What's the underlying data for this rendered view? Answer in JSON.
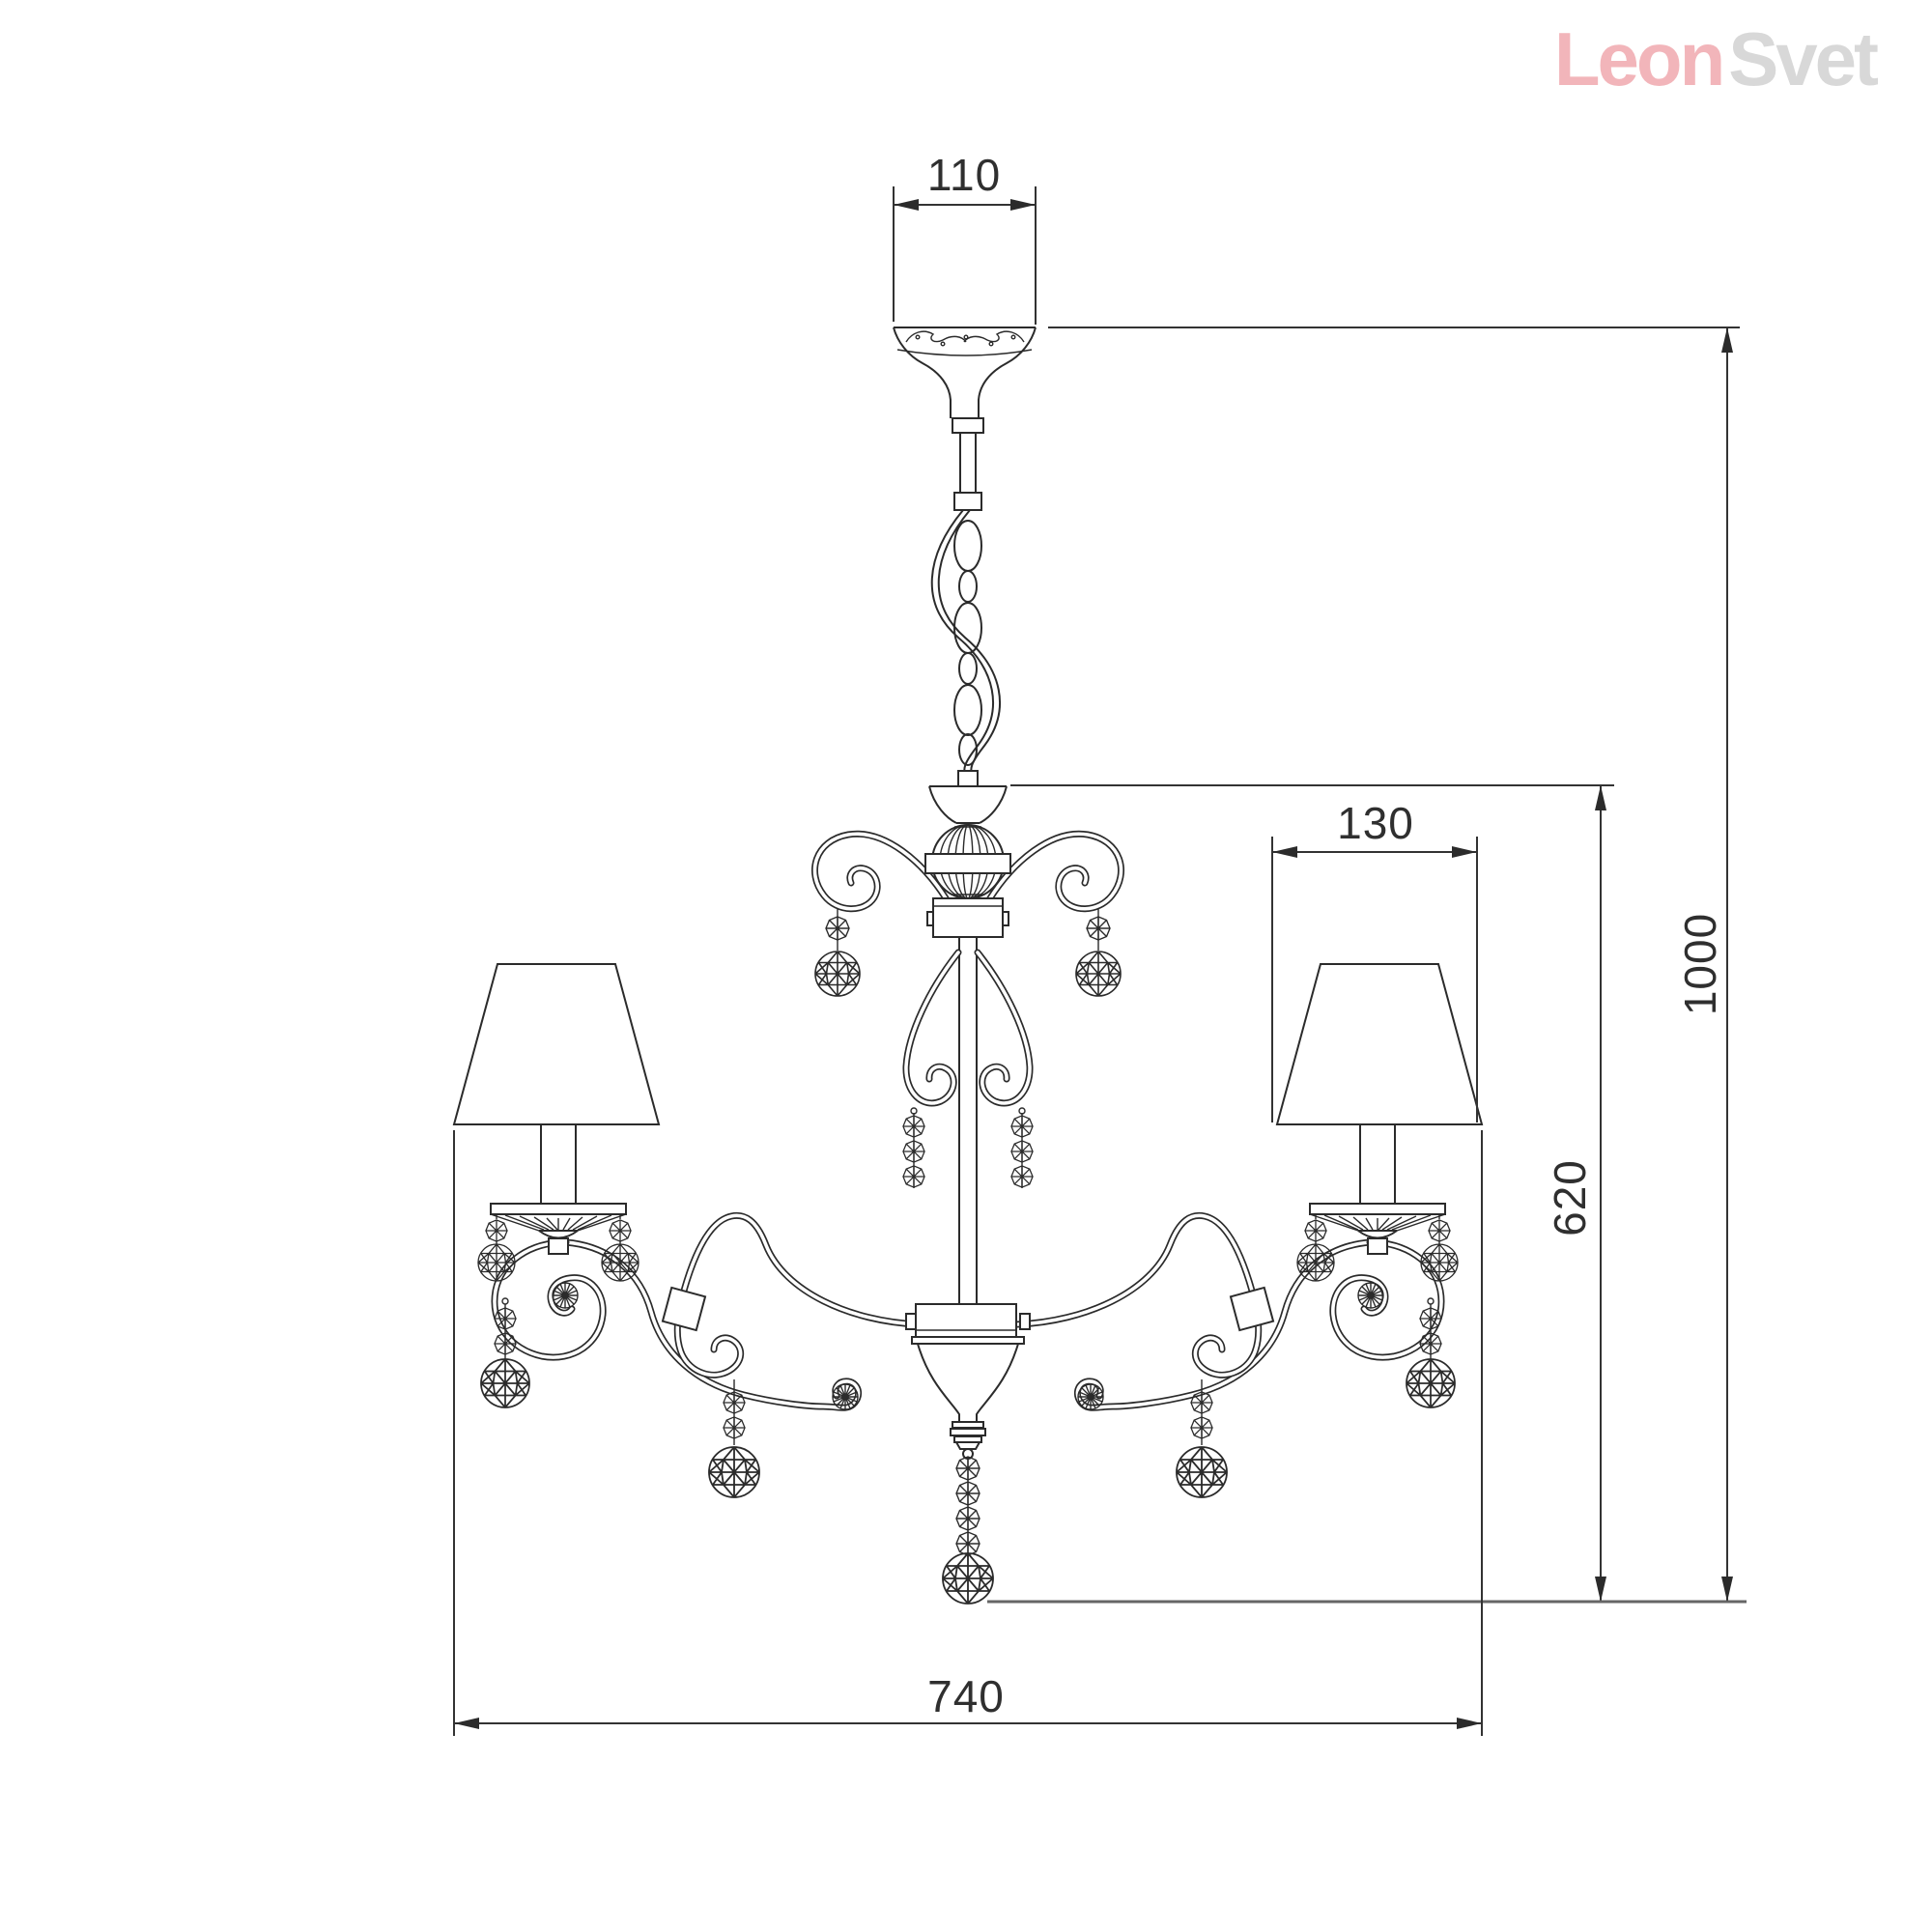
{
  "page": {
    "background": "#ffffff"
  },
  "logo": {
    "text_primary": "Leon",
    "text_secondary": "Svet",
    "color_primary": "#f2b5ba",
    "color_secondary": "#d8d8d8"
  },
  "drawing": {
    "subject": "chandelier-technical-dimension-drawing",
    "line_color": "#2b2b2b",
    "dimensions": {
      "canopy_width": "110",
      "shade_width": "130",
      "overall_height": "1000",
      "body_height": "620",
      "overall_width": "740"
    }
  }
}
